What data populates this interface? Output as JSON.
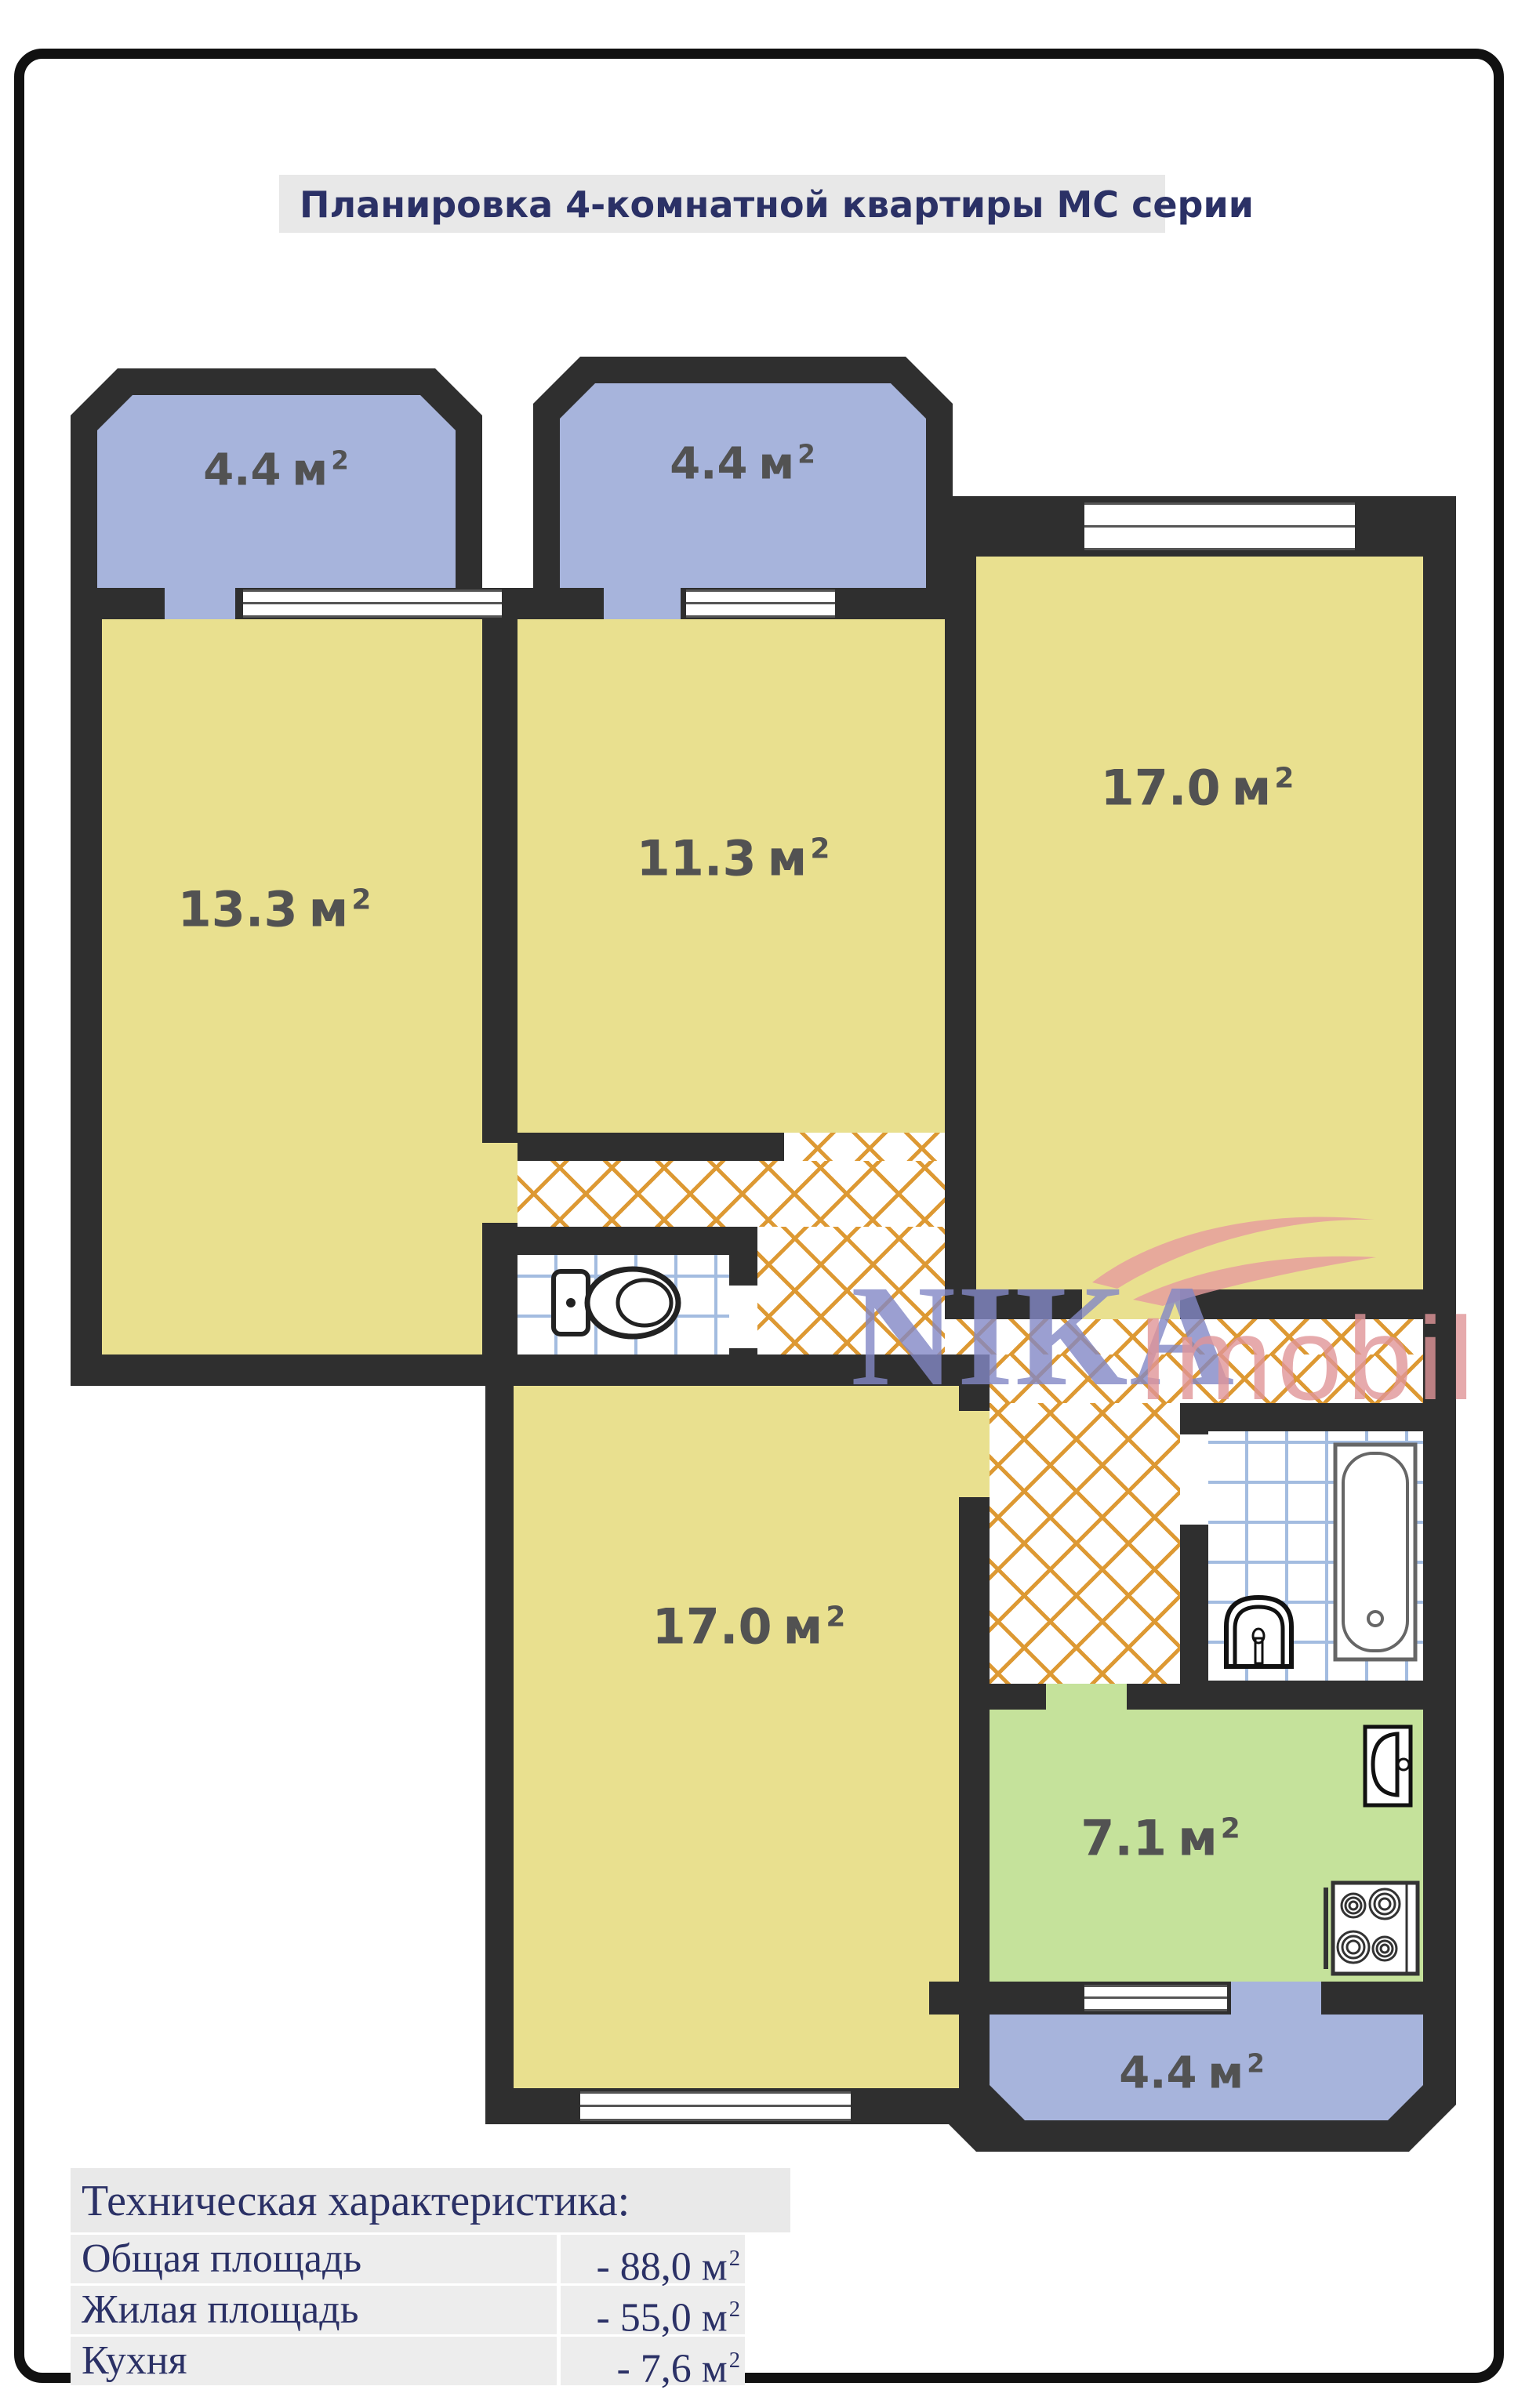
{
  "title": "Планировка 4-комнатной квартиры МС серии",
  "rooms": [
    {
      "id": "balcony-top-left",
      "area": "4.4",
      "unit": "м",
      "sup": "2"
    },
    {
      "id": "balcony-top-middle",
      "area": "4.4",
      "unit": "м",
      "sup": "2"
    },
    {
      "id": "room-left",
      "area": "13.3",
      "unit": "м",
      "sup": "2"
    },
    {
      "id": "room-middle",
      "area": "11.3",
      "unit": "м",
      "sup": "2"
    },
    {
      "id": "room-right",
      "area": "17.0",
      "unit": "м",
      "sup": "2"
    },
    {
      "id": "room-bottom",
      "area": "17.0",
      "unit": "м",
      "sup": "2"
    },
    {
      "id": "kitchen",
      "area": "7.1",
      "unit": "м",
      "sup": "2"
    },
    {
      "id": "balcony-bottom",
      "area": "4.4",
      "unit": "м",
      "sup": "2"
    }
  ],
  "watermark": {
    "brand": "NIKA",
    "suffix": "Imobil"
  },
  "spec_table": {
    "header": "Техническая характеристика:",
    "rows": [
      {
        "label": "Общая площадь",
        "value": "- 88,0",
        "unit": "м",
        "sup": "2"
      },
      {
        "label": "Жилая площадь",
        "value": "- 55,0",
        "unit": "м",
        "sup": "2"
      },
      {
        "label": "Кухня",
        "value": "- 7,6",
        "unit": "м",
        "sup": "2"
      }
    ]
  },
  "colors": {
    "wall": "#2f2f2f",
    "room_yellow": "#e9e08f",
    "balcony_blue": "#a7b4dc",
    "kitchen_green": "#c5e29b",
    "parquet_line": "#dd9933",
    "tile_line": "#a3bce0",
    "heading_navy": "#2b3166",
    "label_gray": "#525252",
    "watermark_purple": "#8388c6",
    "watermark_pink": "#e09598"
  }
}
